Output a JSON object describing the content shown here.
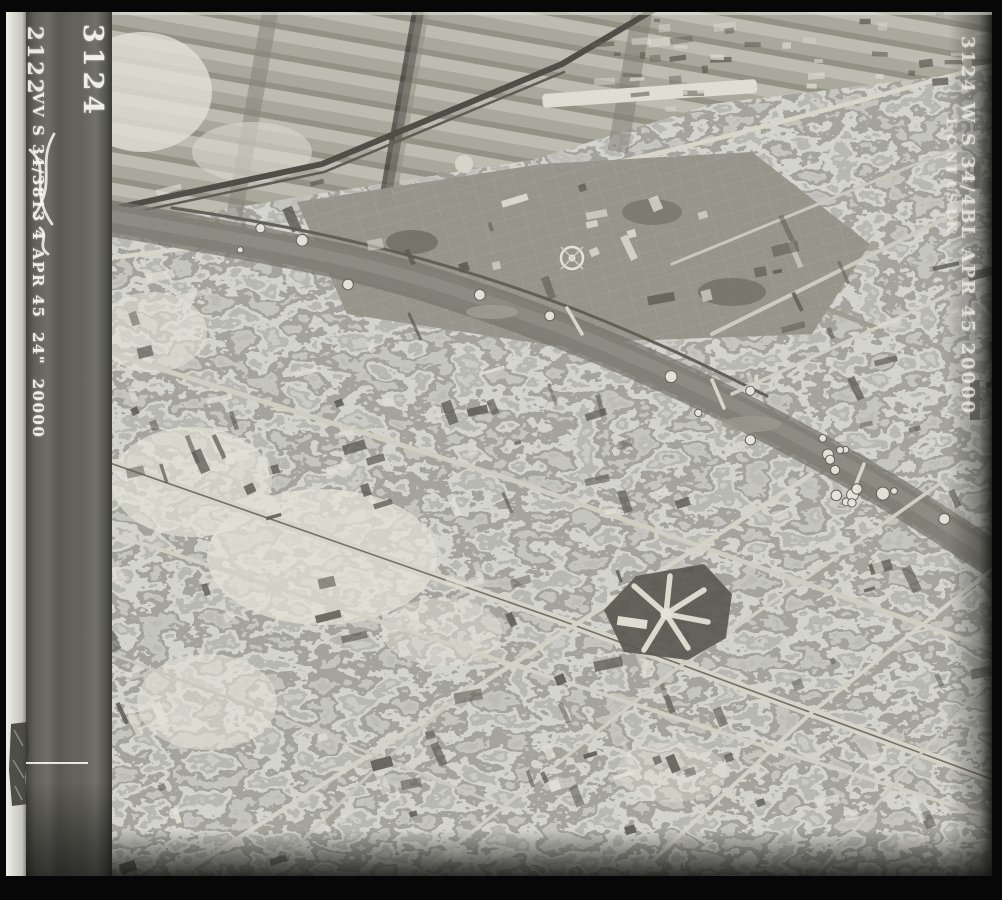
{
  "film_markings": {
    "frame_number": "3124",
    "adjacent_frame_number": "2122",
    "left_strip_data": "VV S 34/3813 4 APR 45  24\"  20000",
    "right_strip_line1": "3124 W S 34/4BL APR 45 20000",
    "right_strip_line2": "E C NT US UK"
  },
  "colors": {
    "border_black": "#070707",
    "film_band_gray": "#62625a",
    "scanner_strip_white": "#d9d9d1",
    "photo_base_gray": "#b6b6ae",
    "river_gray": "#7b7b72",
    "marking_ink": "#efefe5"
  },
  "scene": {
    "description": "Black-and-white WWII vertical aerial reconnaissance photograph of a bomb-damaged city: strip fields and a railway across the top, a meandering river with crater-pocked banks through the centre, a formal garden with circular rond-point, dense urban street grids below, and a radial prison complex right of centre."
  }
}
